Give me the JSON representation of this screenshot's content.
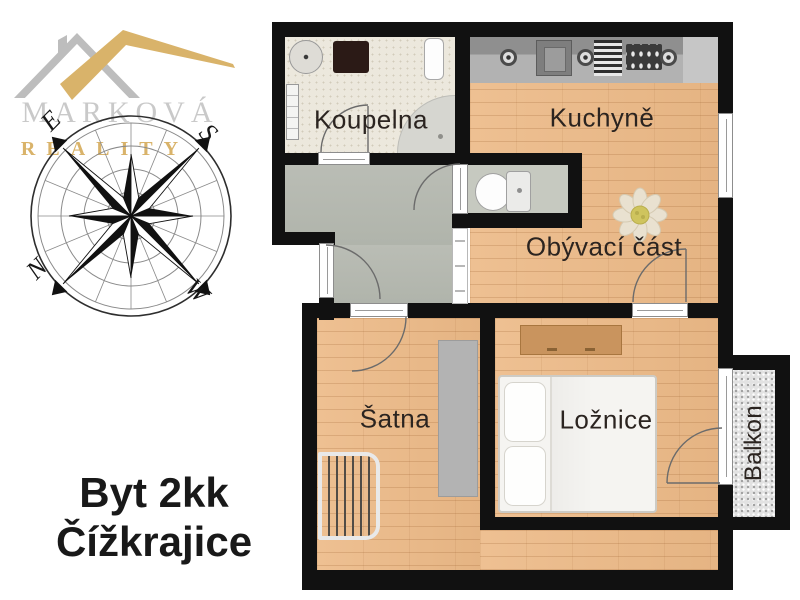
{
  "brand": {
    "name": "MARKOVÁ",
    "subtitle": "REALITY",
    "gold_color": "#d9b36a",
    "gray_color": "#c9c9c9"
  },
  "compass": {
    "east": "E",
    "south": "S",
    "north": "N",
    "west": "W"
  },
  "title": {
    "line1": "Byt 2kk",
    "line2": "Čížkrajice"
  },
  "floorplan": {
    "rooms": [
      {
        "id": "koupelna",
        "label": "Koupelna"
      },
      {
        "id": "kuchyne",
        "label": "Kuchyně"
      },
      {
        "id": "obyvaci-cast",
        "label": "Obývací část"
      },
      {
        "id": "satna",
        "label": "Šatna"
      },
      {
        "id": "loznice",
        "label": "Ložnice"
      },
      {
        "id": "balkon",
        "label": "Balkon"
      }
    ],
    "colors": {
      "wall": "#111111",
      "wood_floor": "#eabd8e",
      "hallway_floor": "#b6bab1",
      "bathroom_floor": "#ece8dd",
      "wc_floor": "#c6c9c0",
      "balcony_floor": "#e2e2e2",
      "counter": "#a0a0a0",
      "label_text": "#2b2420",
      "title_text": "#191919"
    }
  }
}
